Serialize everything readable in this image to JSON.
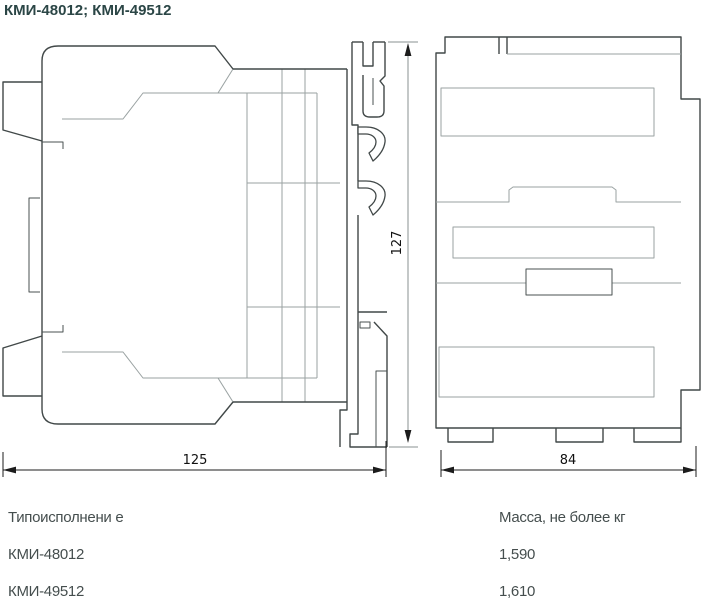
{
  "title": "КМИ-48012; КМИ-49512",
  "dimensions": {
    "side_width": "125",
    "side_height": "127",
    "front_width": "84"
  },
  "spec_table": {
    "type_header": "Типоисполнени е",
    "mass_header": "Масса, не более кг",
    "rows": [
      {
        "type": "КМИ-48012",
        "mass": "1,590"
      },
      {
        "type": "КМИ-49512",
        "mass": "1,610"
      }
    ]
  },
  "colors": {
    "title": "#2b4646",
    "outline_dark": "#414848",
    "outline_light": "#9aa2a2",
    "dimension": "#1c1c1c"
  }
}
